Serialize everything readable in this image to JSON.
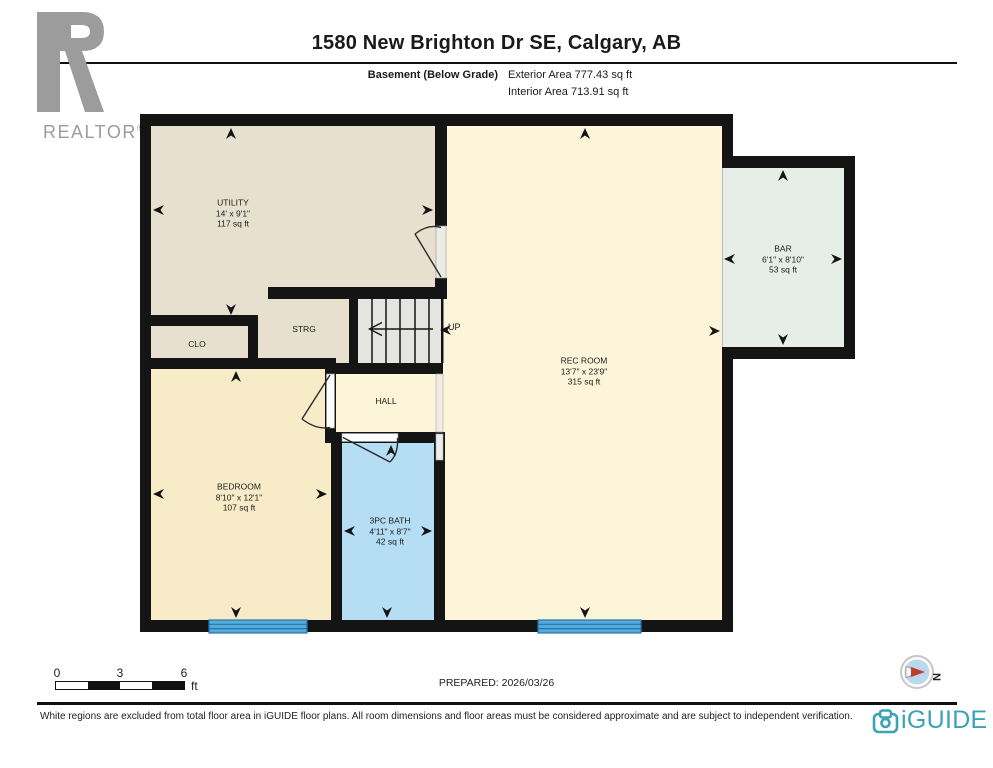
{
  "header": {
    "title": "1580 New Brighton Dr SE, Calgary, AB",
    "floor_label": "Basement (Below Grade)",
    "exterior_area": "Exterior Area 777.43 sq ft",
    "interior_area": "Interior Area 713.91 sq ft"
  },
  "realtor": {
    "wordmark": "REALTOR",
    "registered": "®"
  },
  "rooms": {
    "utility": {
      "name": "UTILITY",
      "dims": "14' x 9'1\"",
      "area": "117 sq ft"
    },
    "strg": {
      "name": "STRG"
    },
    "clo": {
      "name": "CLO"
    },
    "hall": {
      "name": "HALL"
    },
    "rec_room": {
      "name": "REC ROOM",
      "dims": "13'7\" x 23'9\"",
      "area": "315 sq ft"
    },
    "bar": {
      "name": "BAR",
      "dims": "6'1\" x 8'10\"",
      "area": "53 sq ft"
    },
    "bedroom": {
      "name": "BEDROOM",
      "dims": "8'10\" x 12'1\"",
      "area": "107 sq ft"
    },
    "bath": {
      "name": "3PC BATH",
      "dims": "4'11\" x 8'7\"",
      "area": "42 sq ft"
    }
  },
  "stairs": {
    "up_label": "UP"
  },
  "scale_bar": {
    "labels": [
      "0",
      "3",
      "6"
    ],
    "unit": "ft"
  },
  "prepared_label": "PREPARED: 2026/03/26",
  "compass": {
    "north_label": "N"
  },
  "footer": {
    "disclaimer": "White regions are excluded from total floor area in iGUIDE floor plans. All room dimensions and floor areas must be considered approximate and are subject to independent verification.",
    "brand": "iGUIDE"
  },
  "colors": {
    "wall": "#141414",
    "utility_beige": "#e8e0cf",
    "cream": "#fcf5d9",
    "bedroom_cream": "#f8ecc8",
    "bath_blue": "#b5ddf3",
    "bar_mint": "#e7eee8",
    "stairs_gray": "#e4e4e1",
    "window_blue": "#58aad9",
    "brand_teal": "#3ba2b8",
    "logo_gray": "#9c9c9c"
  }
}
